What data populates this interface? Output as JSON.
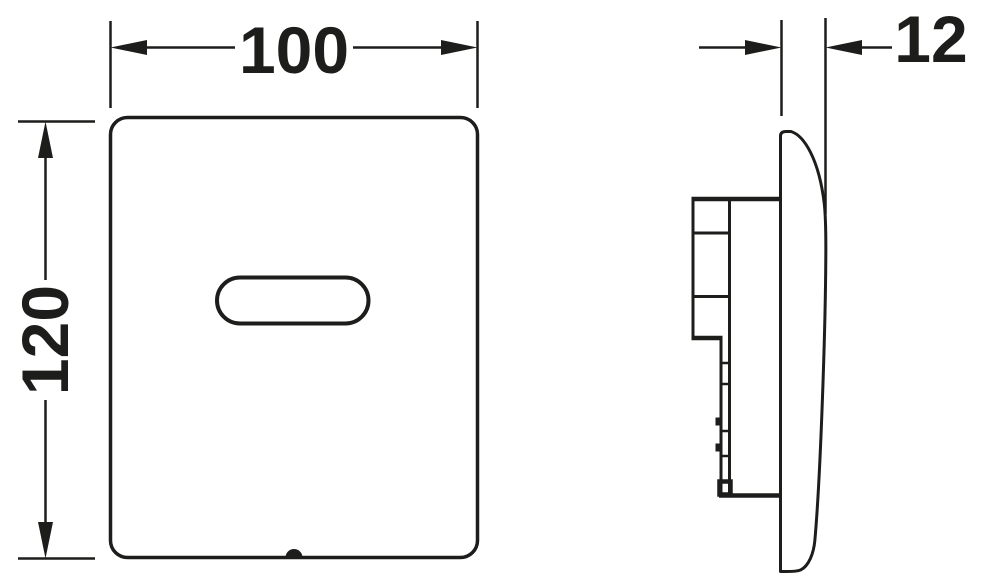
{
  "colors": {
    "line": "#1d1d1b",
    "background": "#ffffff"
  },
  "dimensions": {
    "width": {
      "label": "100"
    },
    "height": {
      "label": "120"
    },
    "depth": {
      "label": "12"
    }
  }
}
